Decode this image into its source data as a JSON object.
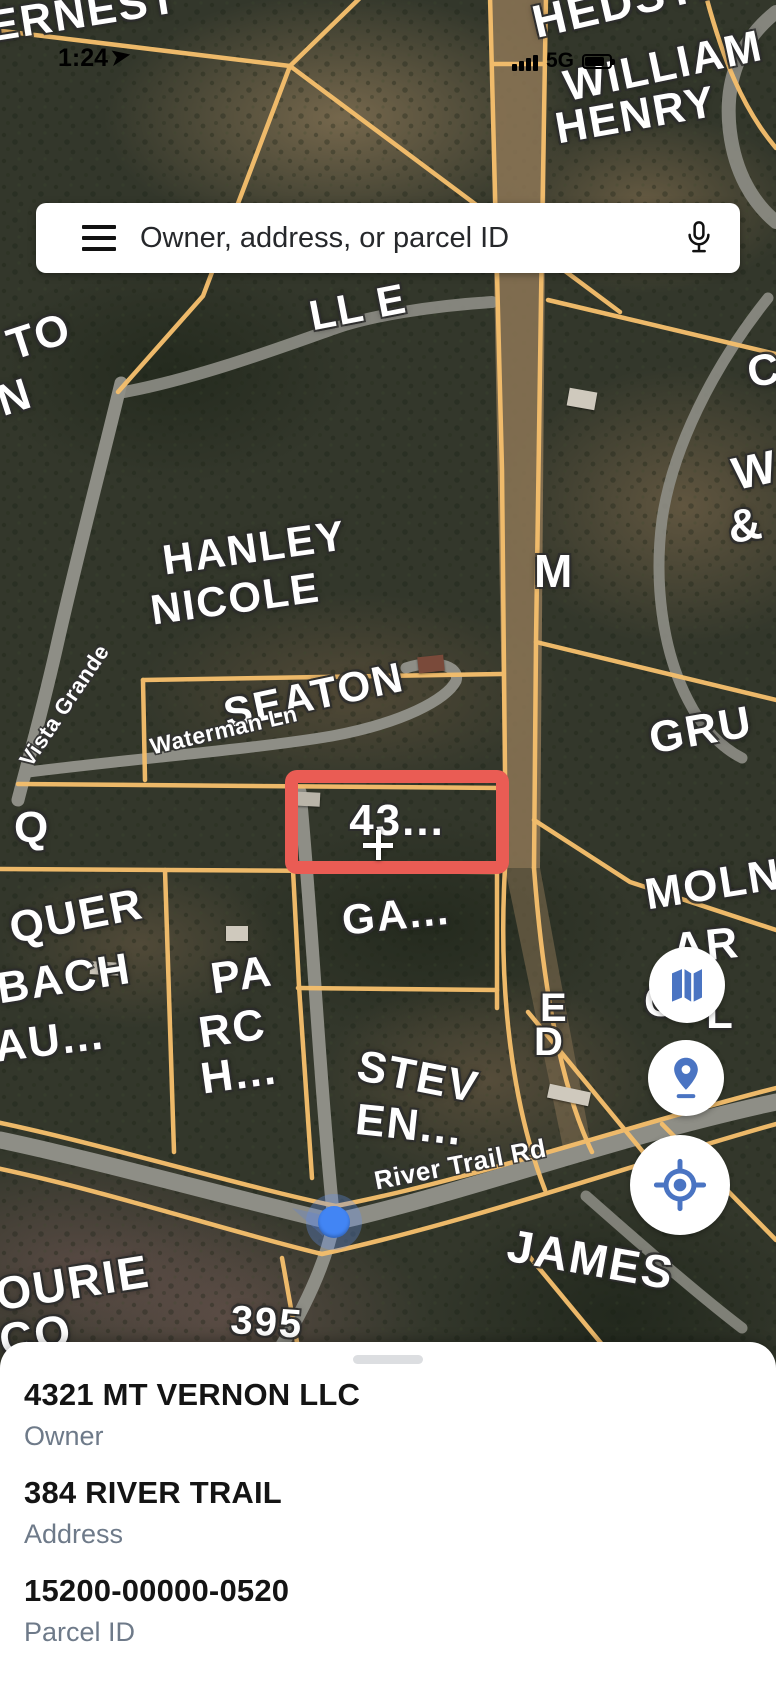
{
  "status_bar": {
    "time": "1:24",
    "network": "5G"
  },
  "search": {
    "placeholder": "Owner, address, or parcel ID"
  },
  "map": {
    "highlighted_parcel": {
      "label": "43..."
    },
    "labels": [
      {
        "text": "ERNEST",
        "x": -14,
        "y": 6,
        "rot": -9,
        "size": 44
      },
      {
        "text": "HEDSTRO",
        "x": 528,
        "y": 0,
        "rot": -13,
        "size": 46
      },
      {
        "text": "WILLIAM",
        "x": 560,
        "y": 66,
        "rot": -12,
        "size": 44
      },
      {
        "text": "HENRY",
        "x": 552,
        "y": 108,
        "rot": -10,
        "size": 44
      },
      {
        "text": "LL E",
        "x": 306,
        "y": 296,
        "rot": -11,
        "size": 42
      },
      {
        "text": "TO",
        "x": 2,
        "y": 326,
        "rot": -18,
        "size": 44
      },
      {
        "text": "N",
        "x": -8,
        "y": 382,
        "rot": -18,
        "size": 44
      },
      {
        "text": "C",
        "x": 744,
        "y": 352,
        "rot": -10,
        "size": 44
      },
      {
        "text": "W",
        "x": 728,
        "y": 452,
        "rot": -12,
        "size": 46
      },
      {
        "text": "&",
        "x": 724,
        "y": 505,
        "rot": -10,
        "size": 46
      },
      {
        "text": "HANLEY",
        "x": 160,
        "y": 540,
        "rot": -8,
        "size": 42
      },
      {
        "text": "NICOLE",
        "x": 148,
        "y": 590,
        "rot": -8,
        "size": 42
      },
      {
        "text": "M",
        "x": 534,
        "y": 548,
        "rot": 0,
        "size": 46
      },
      {
        "text": "SEATON",
        "x": 220,
        "y": 694,
        "rot": -12,
        "size": 42
      },
      {
        "text": "Waterman Ln",
        "x": 148,
        "y": 736,
        "rot": -13,
        "size": 23,
        "kind": "road"
      },
      {
        "text": "Vista Grande",
        "x": 16,
        "y": 758,
        "rot": -56,
        "size": 22,
        "kind": "road"
      },
      {
        "text": "Q",
        "x": 14,
        "y": 806,
        "rot": 0,
        "size": 44
      },
      {
        "text": "GRU",
        "x": 646,
        "y": 718,
        "rot": -10,
        "size": 44
      },
      {
        "text": "GA...",
        "x": 340,
        "y": 900,
        "rot": -6,
        "size": 42
      },
      {
        "text": "MOLN",
        "x": 642,
        "y": 874,
        "rot": -9,
        "size": 44
      },
      {
        "text": "AR",
        "x": 670,
        "y": 928,
        "rot": -6,
        "size": 44
      },
      {
        "text": "E",
        "x": 540,
        "y": 988,
        "rot": 0,
        "size": 40
      },
      {
        "text": "D",
        "x": 534,
        "y": 1022,
        "rot": 0,
        "size": 40
      },
      {
        "text": "QUER",
        "x": 6,
        "y": 908,
        "rot": -11,
        "size": 44
      },
      {
        "text": "BACH",
        "x": -6,
        "y": 968,
        "rot": -9,
        "size": 44
      },
      {
        "text": "AU...",
        "x": -8,
        "y": 1026,
        "rot": -7,
        "size": 44
      },
      {
        "text": "PA",
        "x": 208,
        "y": 958,
        "rot": -8,
        "size": 44
      },
      {
        "text": "RC",
        "x": 196,
        "y": 1012,
        "rot": -8,
        "size": 44
      },
      {
        "text": "H...",
        "x": 198,
        "y": 1058,
        "rot": -8,
        "size": 44
      },
      {
        "text": "C",
        "x": 644,
        "y": 980,
        "rot": 0,
        "size": 44
      },
      {
        "text": "L",
        "x": 706,
        "y": 992,
        "rot": 0,
        "size": 44
      },
      {
        "text": "STEV",
        "x": 362,
        "y": 1044,
        "rot": 11,
        "size": 44
      },
      {
        "text": "EN...",
        "x": 358,
        "y": 1098,
        "rot": 6,
        "size": 44
      },
      {
        "text": "River Trail Rd",
        "x": 372,
        "y": 1168,
        "rot": -11,
        "size": 26,
        "kind": "road"
      },
      {
        "text": "JAMES",
        "x": 512,
        "y": 1222,
        "rot": 10,
        "size": 46
      },
      {
        "text": "OURIE",
        "x": -8,
        "y": 1272,
        "rot": -9,
        "size": 46
      },
      {
        "text": "CO",
        "x": -4,
        "y": 1318,
        "rot": -9,
        "size": 46
      },
      {
        "text": "395",
        "x": 232,
        "y": 1300,
        "rot": 4,
        "size": 40
      }
    ]
  },
  "controls": {
    "layers_icon": "map-layers",
    "marker_icon": "map-pin",
    "locate_icon": "my-location"
  },
  "bottom_sheet": {
    "fields": [
      {
        "value": "4321 MT VERNON LLC",
        "label": "Owner"
      },
      {
        "value": "384 RIVER TRAIL",
        "label": "Address"
      },
      {
        "value": "15200-00000-0520",
        "label": "Parcel ID"
      }
    ]
  },
  "colors": {
    "parcel_line": "#f4be6c",
    "parcel_highlight": "#ea5c54",
    "location_dot": "#4285f4",
    "control_icon": "#4a74c2",
    "label_gray": "#6e7a89"
  }
}
